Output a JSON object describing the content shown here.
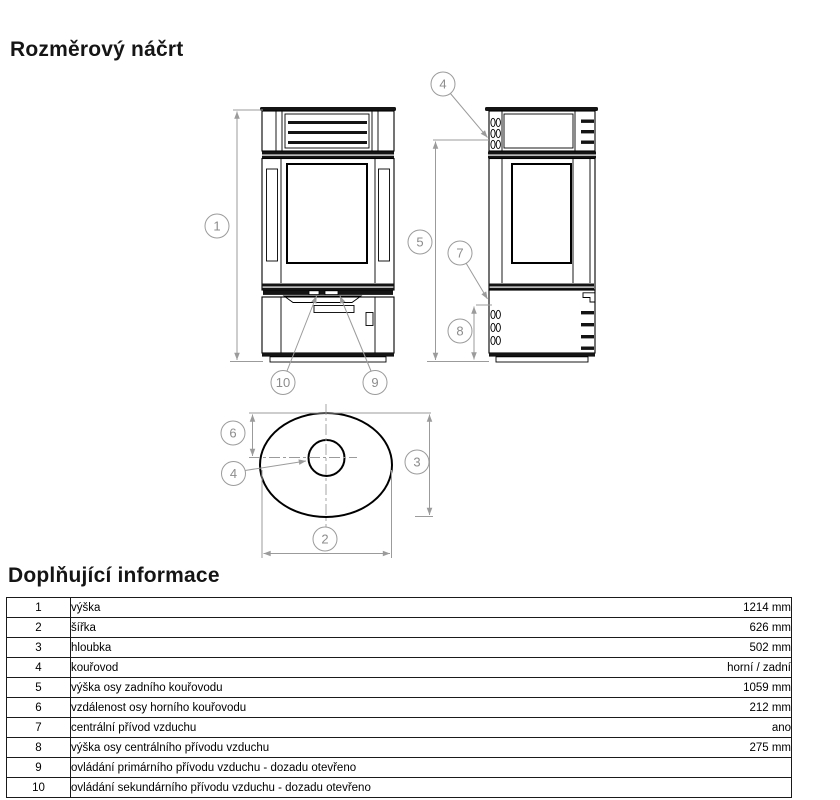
{
  "page": {
    "title_drawing": "Rozměrový náčrt",
    "title_info": "Doplňující informace"
  },
  "diagram": {
    "callouts": {
      "c1": "1",
      "c2": "2",
      "c3": "3",
      "c4a": "4",
      "c4b": "4",
      "c5": "5",
      "c6": "6",
      "c7": "7",
      "c8": "8",
      "c9": "9",
      "c10": "10"
    }
  },
  "info_table": {
    "rows": [
      {
        "num": "1",
        "label": "výška",
        "value": "1214 mm"
      },
      {
        "num": "2",
        "label": "šířka",
        "value": "626 mm"
      },
      {
        "num": "3",
        "label": "hloubka",
        "value": "502 mm"
      },
      {
        "num": "4",
        "label": "kouřovod",
        "value": "horní / zadní"
      },
      {
        "num": "5",
        "label": "výška osy zadního kouřovodu",
        "value": "1059 mm"
      },
      {
        "num": "6",
        "label": "vzdálenost osy horního kouřovodu",
        "value": "212 mm"
      },
      {
        "num": "7",
        "label": "centrální přívod vzduchu",
        "value": "ano"
      },
      {
        "num": "8",
        "label": "výška osy centrálního přívodu vzduchu",
        "value": "275 mm"
      },
      {
        "num": "9",
        "label": "ovládání primárního přívodu vzduchu - dozadu otevřeno",
        "value": ""
      },
      {
        "num": "10",
        "label": "ovládání sekundárního přívodu vzduchu - dozadu otevřeno",
        "value": ""
      }
    ]
  }
}
